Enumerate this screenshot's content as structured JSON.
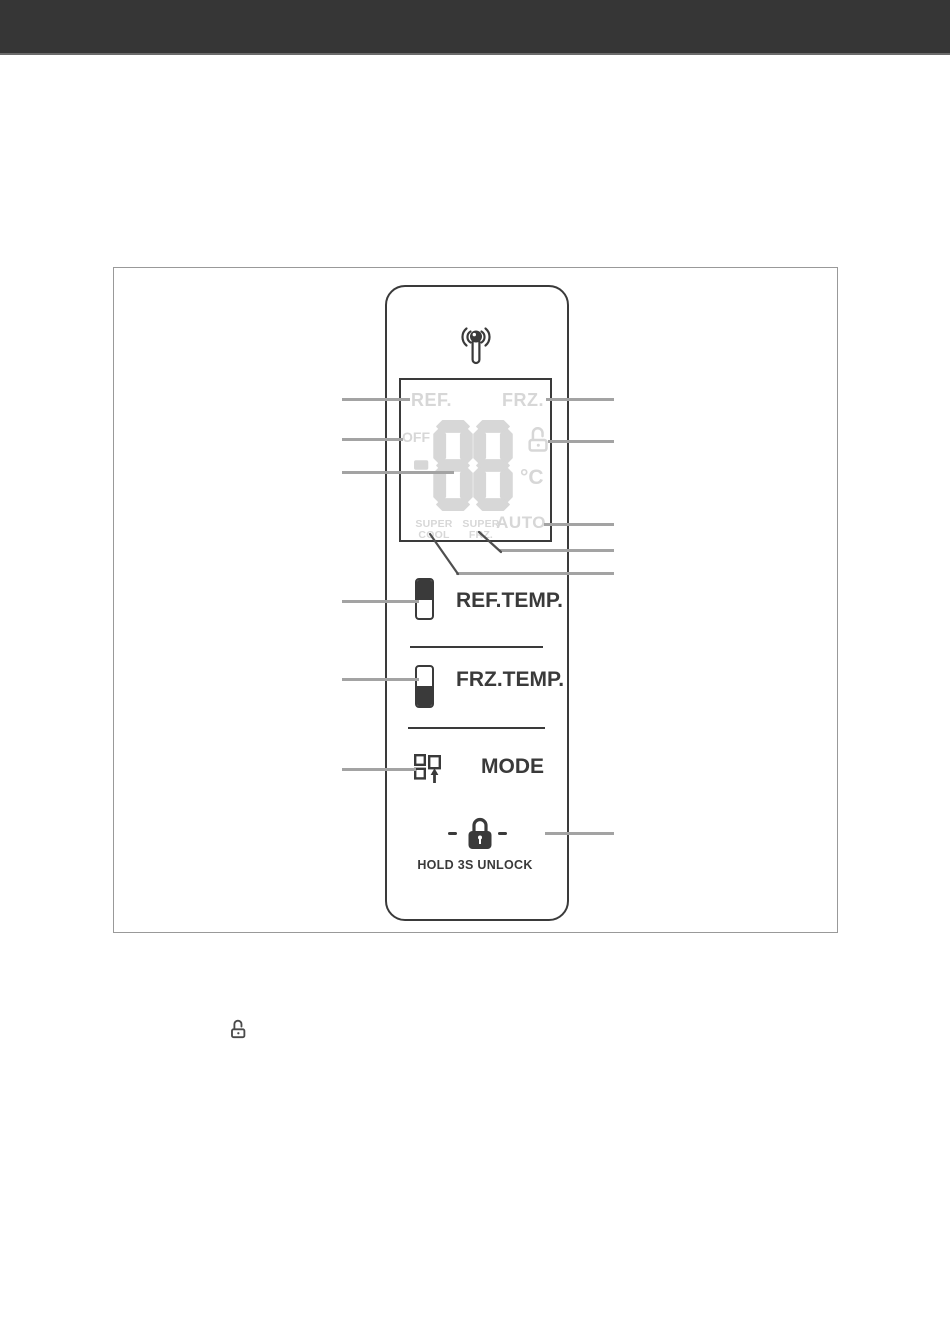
{
  "figure": {
    "panel": {
      "display": {
        "ref": "REF.",
        "frz": "FRZ.",
        "off": "OFF",
        "value": "-88",
        "unit": "°C",
        "super_cool_1": "SUPER",
        "super_cool_2": "COOL",
        "super_frz_1": "SUPER",
        "super_frz_2": "FRZ.",
        "auto": "AUTO"
      },
      "controls": {
        "ref_temp": "REF.TEMP.",
        "frz_temp": "FRZ.TEMP.",
        "mode": "MODE",
        "hold_unlock": "HOLD 3S UNLOCK"
      },
      "icons": {
        "wifi": "wifi-antenna-icon",
        "display_unlock": "unlock-icon",
        "mode": "mode-squares-icon",
        "lock": "lock-icon",
        "inline_unlock": "unlock-icon"
      }
    }
  },
  "colors": {
    "header_bar": "#363636",
    "header_edge": "#6b6b6b",
    "line_dark": "#3a3a3a",
    "lcd": "#d7d7d7",
    "callout": "#a3a3a3",
    "figure_border": "#999999"
  }
}
